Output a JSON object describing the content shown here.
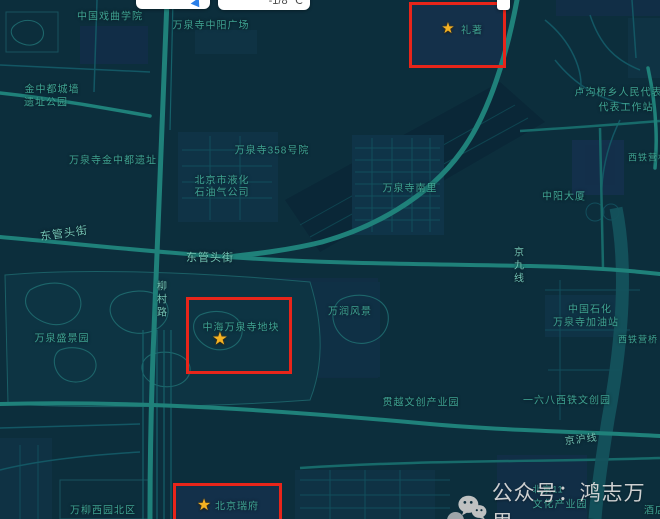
{
  "colors": {
    "highlight_red": "#e8251a",
    "star": "#f4b223",
    "map_label": "#3fa392",
    "street_label": "#74c4b4",
    "watermark_text": "#d9d9d9",
    "map_background": "#0c2e3c",
    "road_bright": "#1f817a",
    "building_navy": "#13304b"
  },
  "widgets": {
    "temperature": "-1/8 ℃"
  },
  "watermark": {
    "text": "公众号：鸿志万里"
  },
  "map": {
    "labels": [
      {
        "text": "中国戏曲学院",
        "x": 110,
        "y": 15,
        "fs": 10
      },
      {
        "text": "万泉寺中阳广场",
        "x": 211,
        "y": 24,
        "fs": 10
      },
      {
        "text": "金中都城墙",
        "x": 52,
        "y": 88,
        "fs": 10
      },
      {
        "text": "遗址公园",
        "x": 46,
        "y": 101,
        "fs": 10
      },
      {
        "text": "卢沟桥乡人民代表大",
        "x": 624,
        "y": 91,
        "fs": 10
      },
      {
        "text": "代表工作站",
        "x": 626,
        "y": 106,
        "fs": 10
      },
      {
        "text": "万泉寺358号院",
        "x": 272,
        "y": 149,
        "fs": 10
      },
      {
        "text": "万泉寺金中都遗址",
        "x": 113,
        "y": 159,
        "fs": 10
      },
      {
        "text": "北京市液化",
        "x": 222,
        "y": 179,
        "fs": 10
      },
      {
        "text": "石油气公司",
        "x": 222,
        "y": 191,
        "fs": 10
      },
      {
        "text": "万泉寺南里",
        "x": 410,
        "y": 187,
        "fs": 10
      },
      {
        "text": "中阳大厦",
        "x": 564,
        "y": 195,
        "fs": 10
      },
      {
        "text": "西铁营村",
        "x": 648,
        "y": 157,
        "fs": 9
      },
      {
        "text": "柳村路",
        "x": 160,
        "y": 300,
        "fs": 10,
        "vertical": true,
        "color": "#74c4b4"
      },
      {
        "text": "东管头街",
        "x": 64,
        "y": 233,
        "fs": 11,
        "rot": -8,
        "color": "#74c4b4"
      },
      {
        "text": "东管头街",
        "x": 210,
        "y": 257,
        "fs": 11,
        "color": "#74c4b4"
      },
      {
        "text": "万泉盛景园",
        "x": 62,
        "y": 337,
        "fs": 10
      },
      {
        "text": "万润风景",
        "x": 350,
        "y": 310,
        "fs": 10
      },
      {
        "text": "京九线",
        "x": 517,
        "y": 266,
        "fs": 10,
        "vertical": true,
        "color": "#74c4b4"
      },
      {
        "text": "中国石化",
        "x": 590,
        "y": 308,
        "fs": 10
      },
      {
        "text": "万泉寺加油站",
        "x": 586,
        "y": 321,
        "fs": 10
      },
      {
        "text": "西铁营桥",
        "x": 638,
        "y": 339,
        "fs": 9
      },
      {
        "text": "贯越文创产业园",
        "x": 421,
        "y": 401,
        "fs": 10
      },
      {
        "text": "一六八西铁文创园",
        "x": 567,
        "y": 399,
        "fs": 10
      },
      {
        "text": "京沪线",
        "x": 581,
        "y": 438,
        "fs": 10,
        "rot": -7,
        "color": "#74c4b4"
      },
      {
        "text": "万柳西园北区",
        "x": 103,
        "y": 509,
        "fs": 10
      },
      {
        "text": "北京11",
        "x": 548,
        "y": 489,
        "fs": 9
      },
      {
        "text": "文化产业园",
        "x": 560,
        "y": 503,
        "fs": 10
      },
      {
        "text": "酒店",
        "x": 655,
        "y": 509,
        "fs": 10
      }
    ],
    "markers": [
      {
        "icon": "★",
        "text": "礼著",
        "sx": 448,
        "sy": 28,
        "star_fs": 15,
        "lx": 472,
        "ly": 29,
        "fs": 10
      },
      {
        "icon": "★",
        "text": "中海万泉寺地块",
        "sx": 220,
        "sy": 339,
        "star_fs": 18,
        "lx": 241,
        "ly": 326,
        "fs": 10
      },
      {
        "icon": "★",
        "text": "北京瑞府",
        "sx": 204,
        "sy": 505,
        "star_fs": 16,
        "lx": 237,
        "ly": 505,
        "fs": 10
      }
    ],
    "highlight_boxes": [
      {
        "x": 409,
        "y": 2,
        "w": 97,
        "h": 66
      },
      {
        "x": 186,
        "y": 297,
        "w": 106,
        "h": 77
      },
      {
        "x": 173,
        "y": 483,
        "w": 109,
        "h": 45
      }
    ]
  }
}
